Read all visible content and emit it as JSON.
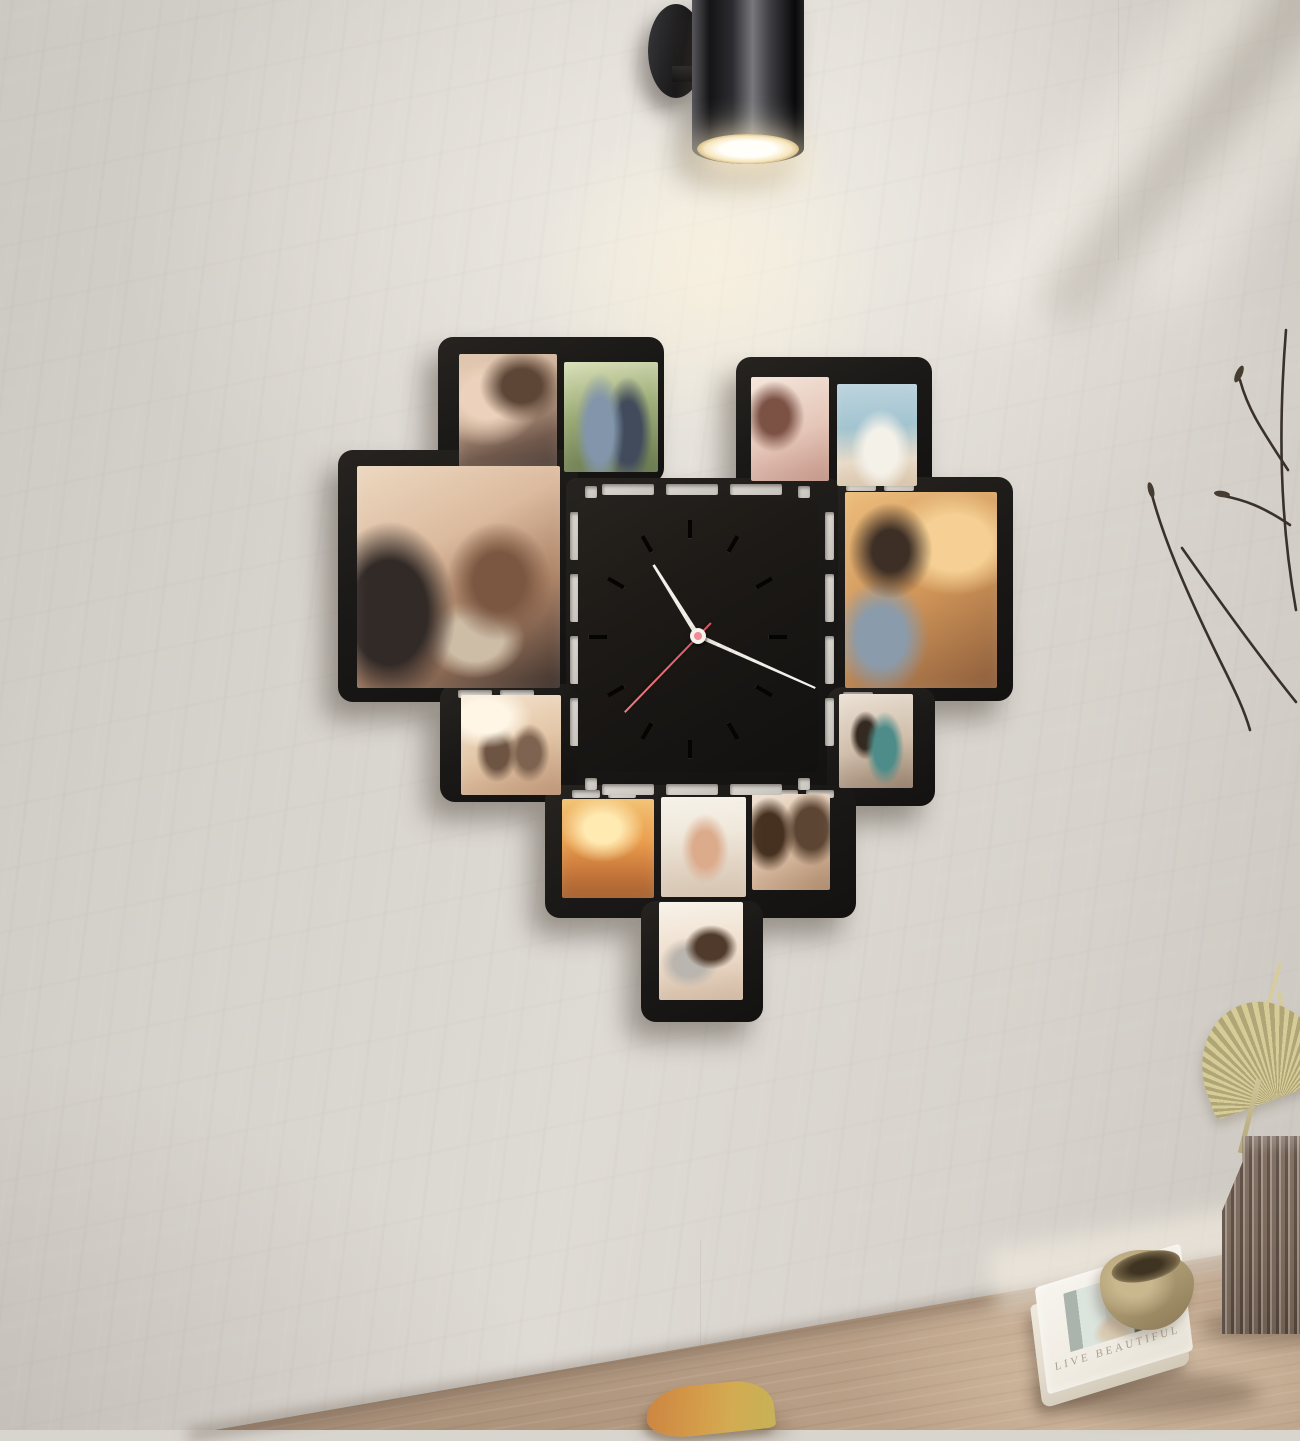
{
  "scene": {
    "description": "Heart-shaped black photo-collage wall clock with twelve couple photos on a textured plaster wall, lit by a black cylindrical wall sconce, above a wooden tabletop with a book, ceramic bowl, ribbed glass vase with dried palm leaf, and a fallen leaf",
    "wall_color": "#d8d4ce",
    "frame_color": "#1b1917",
    "table_wood_color": "#b1977f"
  },
  "lamp": {
    "type": "cylinder-wall-sconce",
    "body_color": "#2c2c30",
    "light_color": "#fffef8",
    "state": "on"
  },
  "clock": {
    "shape": "square-face-with-slotted-border",
    "face_color": "#1b1815",
    "hand_color": "#f3f0ea",
    "second_hand_color": "#e2606b",
    "hour_angle_deg": -32,
    "minute_angle_deg": 114,
    "second_angle_deg": 224,
    "tick_style": "recessed bar markers, 12 positions, no numerals"
  },
  "photos": [
    {
      "id": "photo-couple-hugging",
      "position": "top-left block, left",
      "description": "woman hugging man from behind, warm tones"
    },
    {
      "id": "photo-couple-park",
      "position": "top-left block, right",
      "description": "man in denim shirt and woman in dark dress standing in a sunny park"
    },
    {
      "id": "photo-foreheads-touching",
      "position": "top-right block, left",
      "description": "couple with foreheads touching, soft pink light"
    },
    {
      "id": "photo-seaside-couple",
      "position": "top-right block, right",
      "description": "couple in white shirts embracing by the sea"
    },
    {
      "id": "photo-sunglasses-couple",
      "position": "left large block",
      "description": "man in beanie and leather jacket with laughing woman in scarf, both in sunglasses"
    },
    {
      "id": "photo-golden-light-couple",
      "position": "right large block",
      "description": "red-haired man gazing at dark-haired woman in warm golden light"
    },
    {
      "id": "photo-cafe-couple",
      "position": "middle-left small",
      "description": "couple talking at a cafe table by a bright window"
    },
    {
      "id": "photo-street-couple",
      "position": "middle-right small",
      "description": "man in teal shirt with curly-haired woman on a city street"
    },
    {
      "id": "photo-beach-sunset",
      "position": "bottom row, left",
      "description": "couple running on the beach at orange sunset"
    },
    {
      "id": "photo-piggyback-beach",
      "position": "bottom row, middle",
      "description": "bright photo of couple in sunglasses, piggyback ride"
    },
    {
      "id": "photo-cheek-kiss",
      "position": "bottom row, right",
      "description": "couple cheek to cheek laughing"
    },
    {
      "id": "photo-cuddling-bed",
      "position": "bottom tip",
      "description": "couple cuddling in white bedding"
    }
  ],
  "table_items": {
    "book": {
      "title": "LIVE BEAUTIFUL",
      "cover_color": "#f4f1ea"
    },
    "bowl": {
      "color": "#a6946d",
      "material": "ceramic"
    },
    "vase": {
      "material": "ribbed smoked glass",
      "color": "#847366"
    },
    "palm_leaf_color": "#c9bf8b",
    "fallen_leaf_color": "#d49a49"
  }
}
